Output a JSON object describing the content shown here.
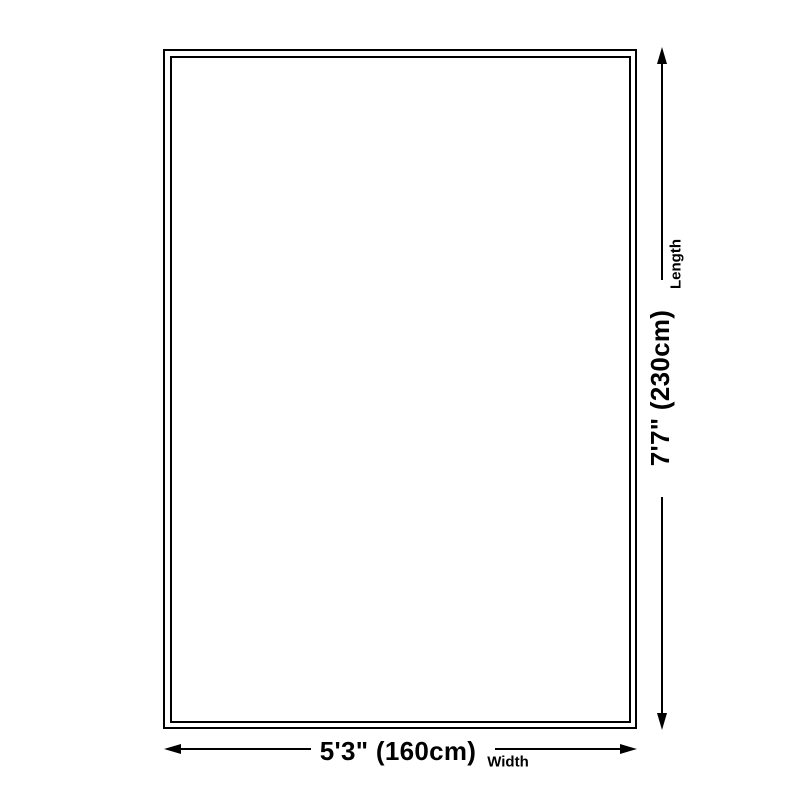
{
  "diagram": {
    "title": "rug size diagram",
    "background_color": "#ffffff",
    "line_color": "#000000",
    "length": {
      "label": "Length",
      "value": "7'7\" (230cm)"
    },
    "width": {
      "label": "Width",
      "value": "5'3\" (160cm)"
    }
  }
}
